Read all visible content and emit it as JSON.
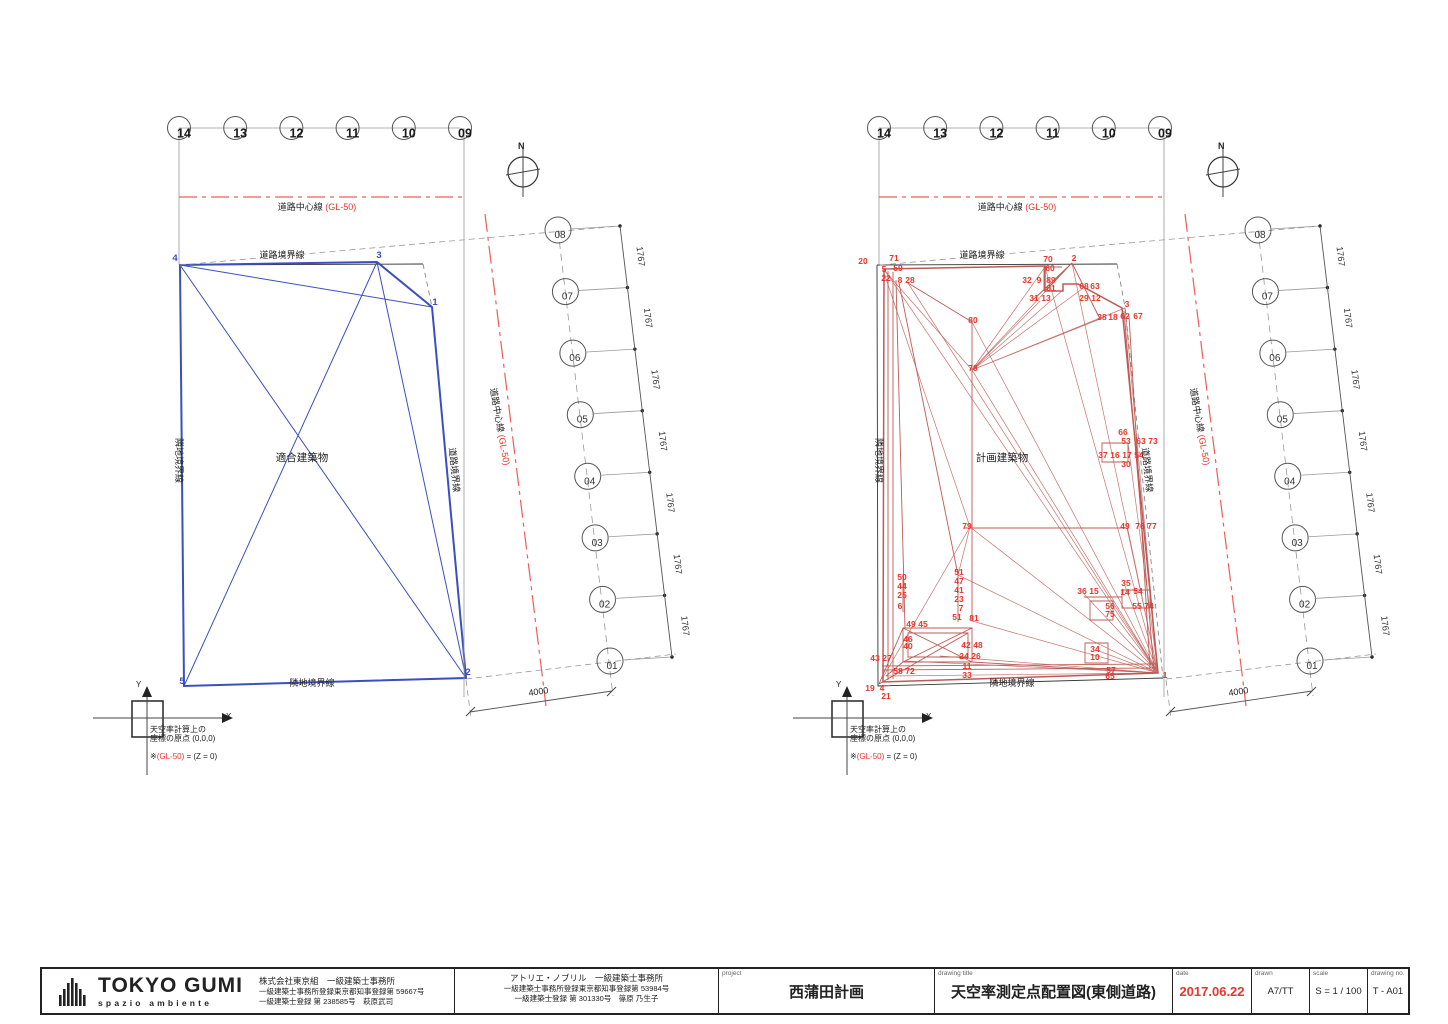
{
  "shared": {
    "grid_bubbles": [
      "14",
      "13",
      "12",
      "11",
      "10",
      "09"
    ],
    "north": "N",
    "road_center_line": "道路中心線",
    "road_center_gl": "(GL-50)",
    "road_boundary": "道路境界線",
    "adjacent_boundary": "隣地境界線",
    "measure_points": [
      "08",
      "07",
      "06",
      "05",
      "04",
      "03",
      "02",
      "01"
    ],
    "dim_interval": "1767",
    "dim_offset": "4000",
    "axis_x": "X",
    "axis_y": "Y",
    "origin_line1": "天空率計算上の",
    "origin_line2": "座標の原点 (0,0,0)",
    "origin_note_pre": "※",
    "origin_note_gl": "(GL-50)",
    "origin_note_post": " = (Z = 0)"
  },
  "left_diagram": {
    "building_label": "適合建築物",
    "vertices": [
      {
        "n": "4",
        "x": 175,
        "y": 261
      },
      {
        "n": "3",
        "x": 379,
        "y": 258
      },
      {
        "n": "1",
        "x": 435,
        "y": 305
      },
      {
        "n": "2",
        "x": 468,
        "y": 675
      },
      {
        "n": "5",
        "x": 182,
        "y": 684
      }
    ]
  },
  "right_diagram": {
    "building_label": "計画建築物",
    "points": [
      {
        "n": "20",
        "x": 863,
        "y": 264
      },
      {
        "n": "71",
        "x": 894,
        "y": 261
      },
      {
        "n": "5",
        "x": 884,
        "y": 272
      },
      {
        "n": "59",
        "x": 898,
        "y": 271
      },
      {
        "n": "22",
        "x": 886,
        "y": 281
      },
      {
        "n": "8",
        "x": 900,
        "y": 283
      },
      {
        "n": "28",
        "x": 910,
        "y": 283
      },
      {
        "n": "70",
        "x": 1048,
        "y": 262
      },
      {
        "n": "2",
        "x": 1074,
        "y": 261
      },
      {
        "n": "60",
        "x": 1050,
        "y": 271
      },
      {
        "n": "32",
        "x": 1027,
        "y": 283
      },
      {
        "n": "9",
        "x": 1039,
        "y": 283
      },
      {
        "n": "89",
        "x": 1051,
        "y": 283
      },
      {
        "n": "61",
        "x": 1051,
        "y": 291
      },
      {
        "n": "68",
        "x": 1084,
        "y": 289
      },
      {
        "n": "63",
        "x": 1095,
        "y": 289
      },
      {
        "n": "31",
        "x": 1034,
        "y": 301
      },
      {
        "n": "13",
        "x": 1046,
        "y": 301
      },
      {
        "n": "29",
        "x": 1084,
        "y": 301
      },
      {
        "n": "12",
        "x": 1096,
        "y": 301
      },
      {
        "n": "3",
        "x": 1127,
        "y": 307
      },
      {
        "n": "38",
        "x": 1102,
        "y": 320
      },
      {
        "n": "18",
        "x": 1113,
        "y": 320
      },
      {
        "n": "62",
        "x": 1125,
        "y": 319
      },
      {
        "n": "67",
        "x": 1138,
        "y": 319
      },
      {
        "n": "80",
        "x": 973,
        "y": 323
      },
      {
        "n": "78",
        "x": 973,
        "y": 371
      },
      {
        "n": "66",
        "x": 1123,
        "y": 435
      },
      {
        "n": "53",
        "x": 1126,
        "y": 444
      },
      {
        "n": "63",
        "x": 1141,
        "y": 444
      },
      {
        "n": "73",
        "x": 1153,
        "y": 444
      },
      {
        "n": "37",
        "x": 1103,
        "y": 458
      },
      {
        "n": "16",
        "x": 1115,
        "y": 458
      },
      {
        "n": "17",
        "x": 1127,
        "y": 458
      },
      {
        "n": "54",
        "x": 1139,
        "y": 458
      },
      {
        "n": "30",
        "x": 1126,
        "y": 467
      },
      {
        "n": "49",
        "x": 1125,
        "y": 529
      },
      {
        "n": "76",
        "x": 1140,
        "y": 529
      },
      {
        "n": "77",
        "x": 1152,
        "y": 529
      },
      {
        "n": "79",
        "x": 967,
        "y": 529
      },
      {
        "n": "50",
        "x": 902,
        "y": 580
      },
      {
        "n": "44",
        "x": 902,
        "y": 589
      },
      {
        "n": "25",
        "x": 902,
        "y": 598
      },
      {
        "n": "6",
        "x": 900,
        "y": 609
      },
      {
        "n": "51",
        "x": 959,
        "y": 575
      },
      {
        "n": "47",
        "x": 959,
        "y": 584
      },
      {
        "n": "41",
        "x": 959,
        "y": 593
      },
      {
        "n": "23",
        "x": 959,
        "y": 602
      },
      {
        "n": "7",
        "x": 961,
        "y": 611
      },
      {
        "n": "51",
        "x": 957,
        "y": 620
      },
      {
        "n": "81",
        "x": 974,
        "y": 621
      },
      {
        "n": "49",
        "x": 911,
        "y": 627
      },
      {
        "n": "45",
        "x": 923,
        "y": 627
      },
      {
        "n": "46",
        "x": 908,
        "y": 642
      },
      {
        "n": "40",
        "x": 908,
        "y": 649
      },
      {
        "n": "42",
        "x": 966,
        "y": 648
      },
      {
        "n": "48",
        "x": 978,
        "y": 648
      },
      {
        "n": "24",
        "x": 964,
        "y": 659
      },
      {
        "n": "26",
        "x": 976,
        "y": 659
      },
      {
        "n": "43",
        "x": 875,
        "y": 661
      },
      {
        "n": "27",
        "x": 887,
        "y": 661
      },
      {
        "n": "58",
        "x": 898,
        "y": 674
      },
      {
        "n": "72",
        "x": 910,
        "y": 674
      },
      {
        "n": "11",
        "x": 967,
        "y": 669
      },
      {
        "n": "33",
        "x": 967,
        "y": 678
      },
      {
        "n": "19",
        "x": 870,
        "y": 691
      },
      {
        "n": "4",
        "x": 882,
        "y": 691
      },
      {
        "n": "21",
        "x": 886,
        "y": 699
      },
      {
        "n": "36",
        "x": 1082,
        "y": 594
      },
      {
        "n": "15",
        "x": 1094,
        "y": 594
      },
      {
        "n": "35",
        "x": 1126,
        "y": 586
      },
      {
        "n": "14",
        "x": 1125,
        "y": 595
      },
      {
        "n": "54",
        "x": 1138,
        "y": 594
      },
      {
        "n": "56",
        "x": 1110,
        "y": 609
      },
      {
        "n": "75",
        "x": 1110,
        "y": 617
      },
      {
        "n": "55",
        "x": 1137,
        "y": 609
      },
      {
        "n": "74",
        "x": 1149,
        "y": 609
      },
      {
        "n": "34",
        "x": 1095,
        "y": 652
      },
      {
        "n": "10",
        "x": 1095,
        "y": 660
      },
      {
        "n": "57",
        "x": 1111,
        "y": 673
      },
      {
        "n": "65",
        "x": 1110,
        "y": 679
      },
      {
        "n": "1",
        "x": 1165,
        "y": 678
      }
    ]
  },
  "titleblock": {
    "logo_name": "TOKYO GUMI",
    "logo_sub": "spazio ambiente",
    "office1_line1": "株式会社東京組　一級建築士事務所",
    "office1_line2": "一級建築士事務所登録東京都知事登録第 59667号",
    "office1_line3": "一級建築士登録 第 238585号　萩原武司",
    "office2_line1": "アトリエ・ノブリル　一級建築士事務所",
    "office2_line2": "一級建築士事務所登録東京都知事登録第 53984号",
    "office2_line3": "一級建築士登録 第 301330号　篠原 乃生子",
    "project_label": "project",
    "project": "西蒲田計画",
    "drawing_title_label": "drawing title",
    "drawing_title": "天空率測定点配置図(東側道路)",
    "date_label": "date",
    "date": "2017.06.22",
    "drawn_label": "drawn",
    "drawn": "A7/TT",
    "scale_label": "scale",
    "scale": "S = 1 / 100",
    "drawing_no_label": "drawing no.",
    "drawing_no": "T - A01"
  },
  "colors": {
    "blue_building": "#3b4fbe",
    "red_building": "#bd5a55",
    "red_accent": "#e8352c",
    "red_centerline": "#ef5d55",
    "line_black": "#333333",
    "line_gray": "#999999"
  }
}
